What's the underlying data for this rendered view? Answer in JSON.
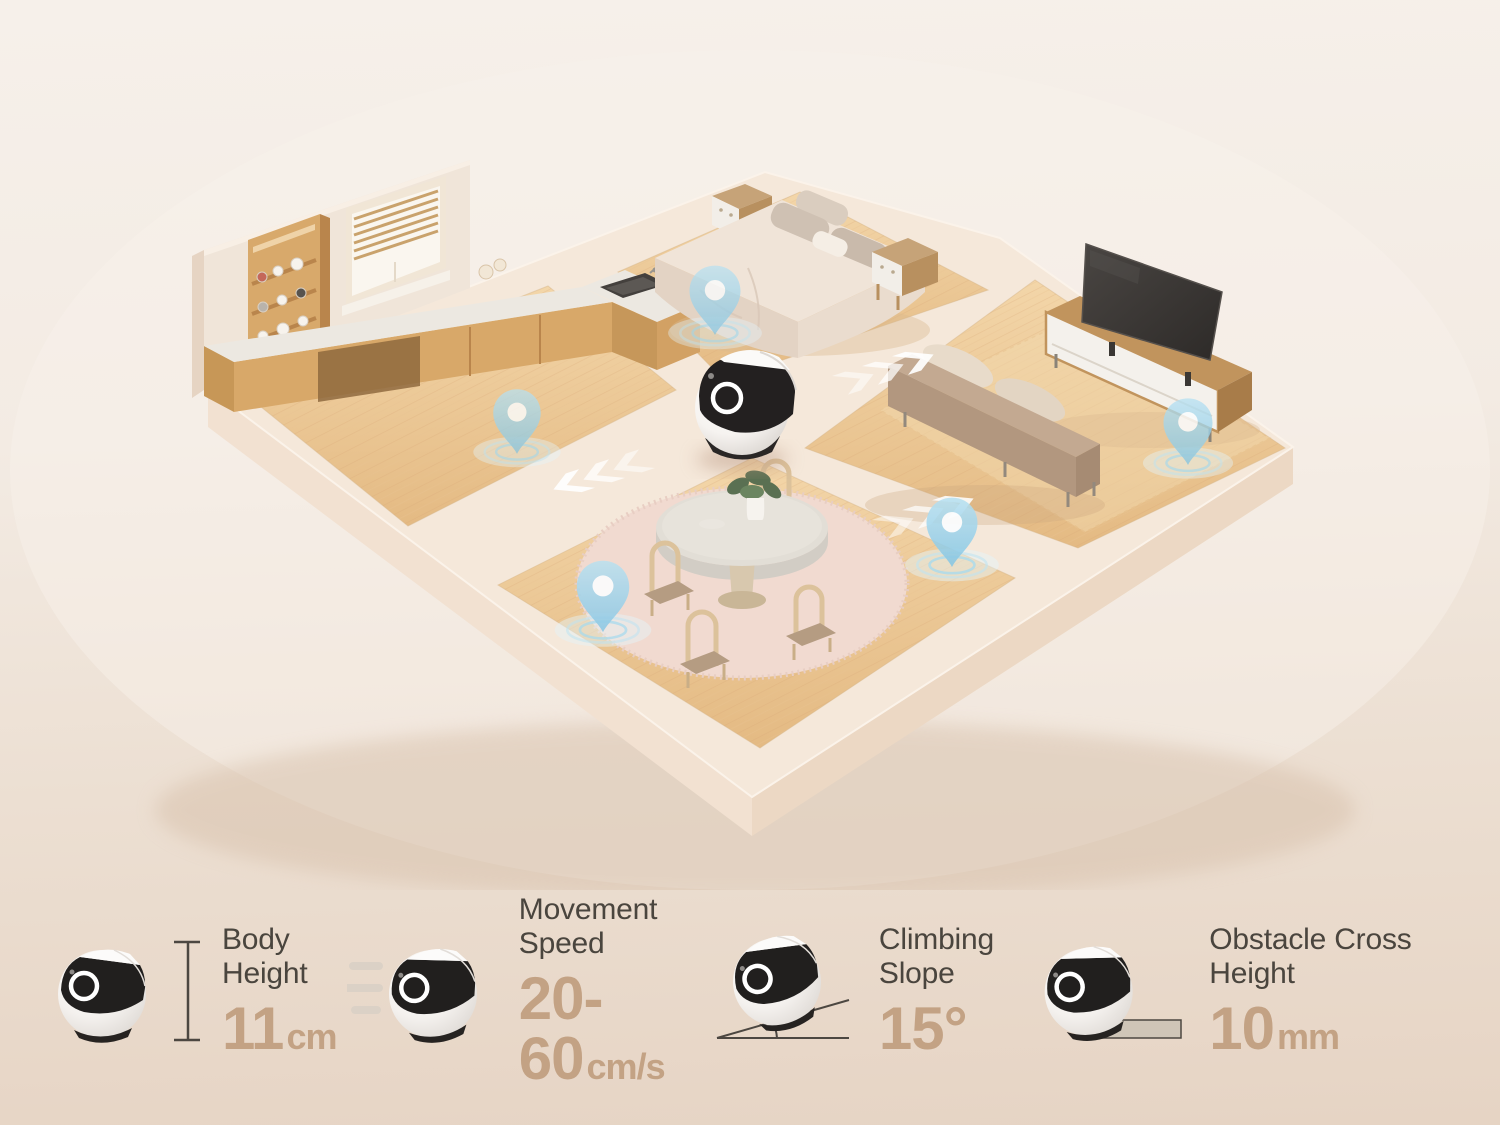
{
  "scene": {
    "rooms": [
      "kitchen",
      "bedroom",
      "living-room",
      "dining-room"
    ],
    "location_pin_count": 5,
    "direction_arrow_group_count": 3
  },
  "specs": {
    "items": [
      {
        "icon": "robot-front-icon",
        "label": "Body Height",
        "value": "11",
        "unit": "cm"
      },
      {
        "icon": "robot-speed-icon",
        "label": "Movement Speed",
        "value": "20-60",
        "unit": "cm/s"
      },
      {
        "icon": "robot-slope-icon",
        "label": "Climbing Slope",
        "value": "15°",
        "unit": ""
      },
      {
        "icon": "robot-obstacle-icon",
        "label": "Obstacle Cross Height",
        "value": "10",
        "unit": "mm"
      }
    ]
  },
  "colors": {
    "background_top": "#f5efe9",
    "background_bottom": "#e6d5c6",
    "pin_blue": "#9ad2ec",
    "wood_floor": "#ecc99b",
    "platform_cream": "#f4e7da",
    "spec_label": "#4a453e",
    "spec_value": "#c3a284"
  }
}
